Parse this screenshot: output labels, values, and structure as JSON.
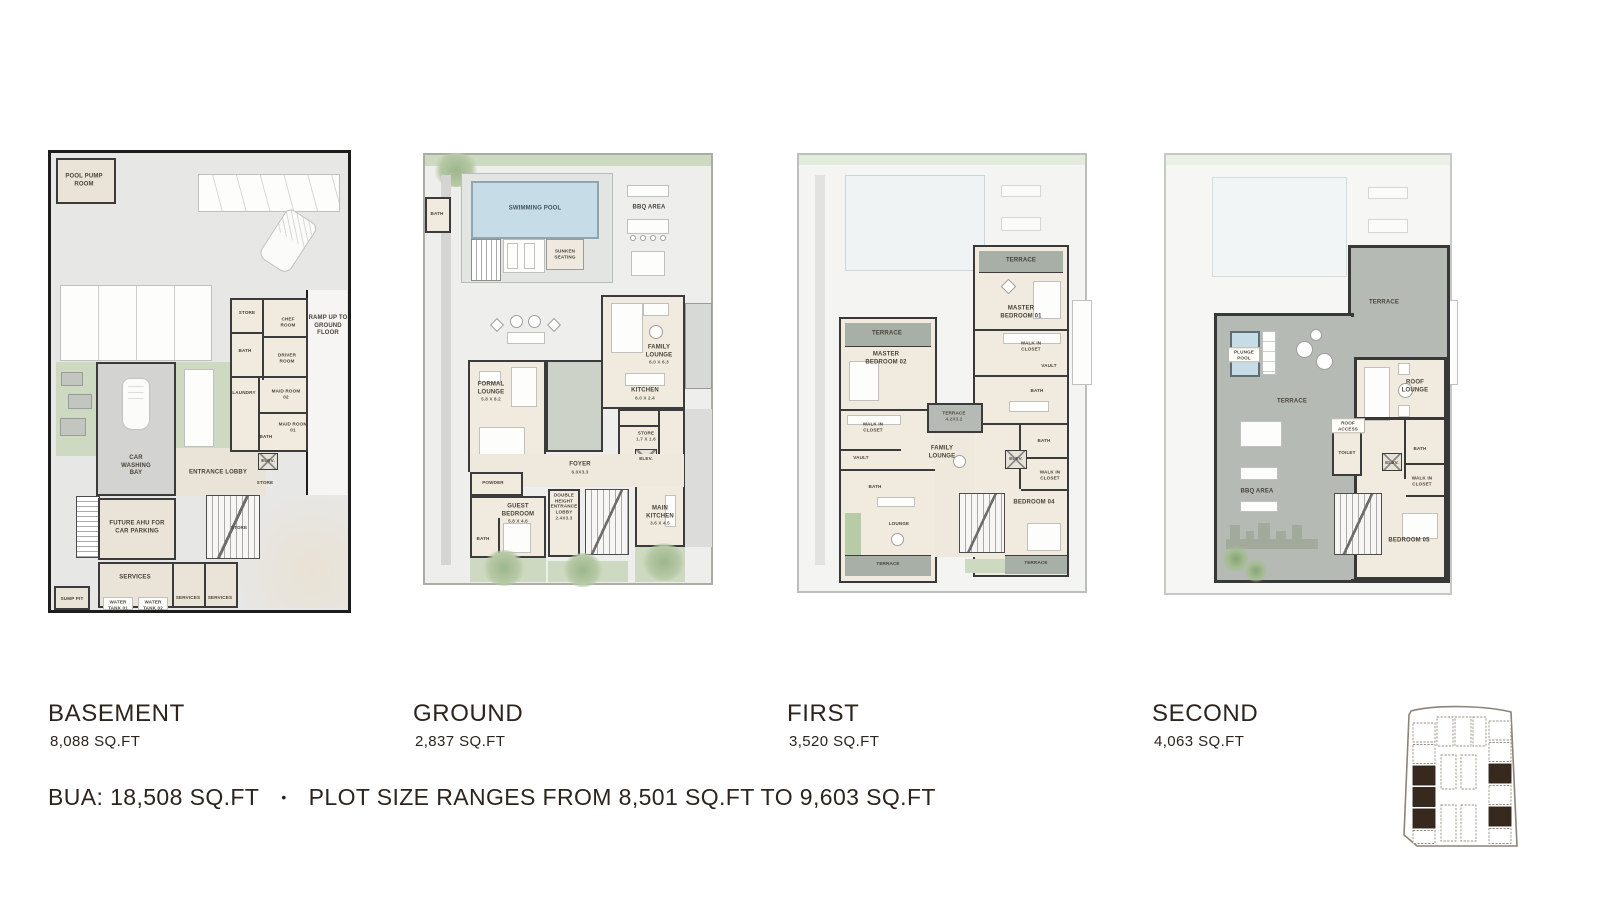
{
  "colors": {
    "text": "#2d241e",
    "basement_wall": "#1d1d1d",
    "wall": "#3b3b3b",
    "room_fill": "#f1eade",
    "terrace_fill": "#b5bbb4",
    "green": "#cdd9c0",
    "pool_water": "#c6dde8",
    "site_plot_dark": "#38291f"
  },
  "floors": [
    {
      "name": "BASEMENT",
      "area": "8,088 SQ.FT",
      "rooms": [
        {
          "label": "POOL PUMP ROOM"
        },
        {
          "label": "RAMP UP TO GROUND FLOOR"
        },
        {
          "label": "STORE"
        },
        {
          "label": "CHEF ROOM"
        },
        {
          "label": "BATH"
        },
        {
          "label": "DRIVER ROOM"
        },
        {
          "label": "LAUNDRY"
        },
        {
          "label": "MAID ROOM 02"
        },
        {
          "label": "MAID ROOM 01"
        },
        {
          "label": "BATH"
        },
        {
          "label": "ELEV."
        },
        {
          "label": "STORE"
        },
        {
          "label": "CAR WASHING BAY"
        },
        {
          "label": "ENTRANCE LOBBY"
        },
        {
          "label": "FUTURE AHU FOR CAR PARKING"
        },
        {
          "label": "SERVICES"
        },
        {
          "label": "SUMP PIT"
        },
        {
          "label": "WATER TANK 01"
        },
        {
          "label": "WATER TANK 02"
        },
        {
          "label": "SERVICES"
        },
        {
          "label": "SERVICES"
        },
        {
          "label": "STORE"
        }
      ]
    },
    {
      "name": "GROUND",
      "area": "2,837 SQ.FT",
      "rooms": [
        {
          "label": "SWIMMING POOL"
        },
        {
          "label": "BBQ AREA"
        },
        {
          "label": "SUNKEN SEATING"
        },
        {
          "label": "BATH"
        },
        {
          "label": "FAMILY LOUNGE",
          "dims": "6.0 X 6.3"
        },
        {
          "label": "KITCHEN",
          "dims": "6.0 X 2.4"
        },
        {
          "label": "STORE",
          "dims": "1.7 X 1.6"
        },
        {
          "label": "ELEV."
        },
        {
          "label": "FORMAL LOUNGE",
          "dims": "5.8 X 8.2"
        },
        {
          "label": "FOYER",
          "dims": "6.0X3.3"
        },
        {
          "label": "POWDER"
        },
        {
          "label": "DOUBLE HEIGHT ENTRANCE LOBBY",
          "dims": "2.4X3.3"
        },
        {
          "label": "GUEST BEDROOM",
          "dims": "5.8 X 4.6"
        },
        {
          "label": "BATH"
        },
        {
          "label": "MAIN KITCHEN",
          "dims": "3.6 X 4.5"
        }
      ]
    },
    {
      "name": "FIRST",
      "area": "3,520 SQ.FT",
      "rooms": [
        {
          "label": "TERRACE"
        },
        {
          "label": "MASTER BEDROOM 01"
        },
        {
          "label": "WALK IN CLOSET"
        },
        {
          "label": "VAULT"
        },
        {
          "label": "BATH"
        },
        {
          "label": "TERRACE"
        },
        {
          "label": "MASTER BEDROOM 02"
        },
        {
          "label": "WALK IN CLOSET"
        },
        {
          "label": "VAULT"
        },
        {
          "label": "BATH"
        },
        {
          "label": "TERRACE",
          "dims": "4.2X3.2"
        },
        {
          "label": "FAMILY LOUNGE"
        },
        {
          "label": "ELEV."
        },
        {
          "label": "BATH"
        },
        {
          "label": "WALK IN CLOSET"
        },
        {
          "label": "BEDROOM 04"
        },
        {
          "label": "LOUNGE"
        },
        {
          "label": "TERRACE"
        },
        {
          "label": "TERRACE"
        }
      ]
    },
    {
      "name": "SECOND",
      "area": "4,063 SQ.FT",
      "rooms": [
        {
          "label": "TERRACE"
        },
        {
          "label": "PLUNGE POOL"
        },
        {
          "label": "TERRACE"
        },
        {
          "label": "BBQ AREA"
        },
        {
          "label": "ROOF LOUNGE"
        },
        {
          "label": "ROOF ACCESS"
        },
        {
          "label": "TOILET"
        },
        {
          "label": "ELEV."
        },
        {
          "label": "BATH"
        },
        {
          "label": "WALK IN CLOSET"
        },
        {
          "label": "BEDROOM 05"
        }
      ]
    }
  ],
  "summary": {
    "bua": "BUA: 18,508 SQ.FT",
    "separator": "•",
    "plot_range": "PLOT SIZE RANGES FROM 8,501 SQ.FT TO 9,603 SQ.FT"
  }
}
